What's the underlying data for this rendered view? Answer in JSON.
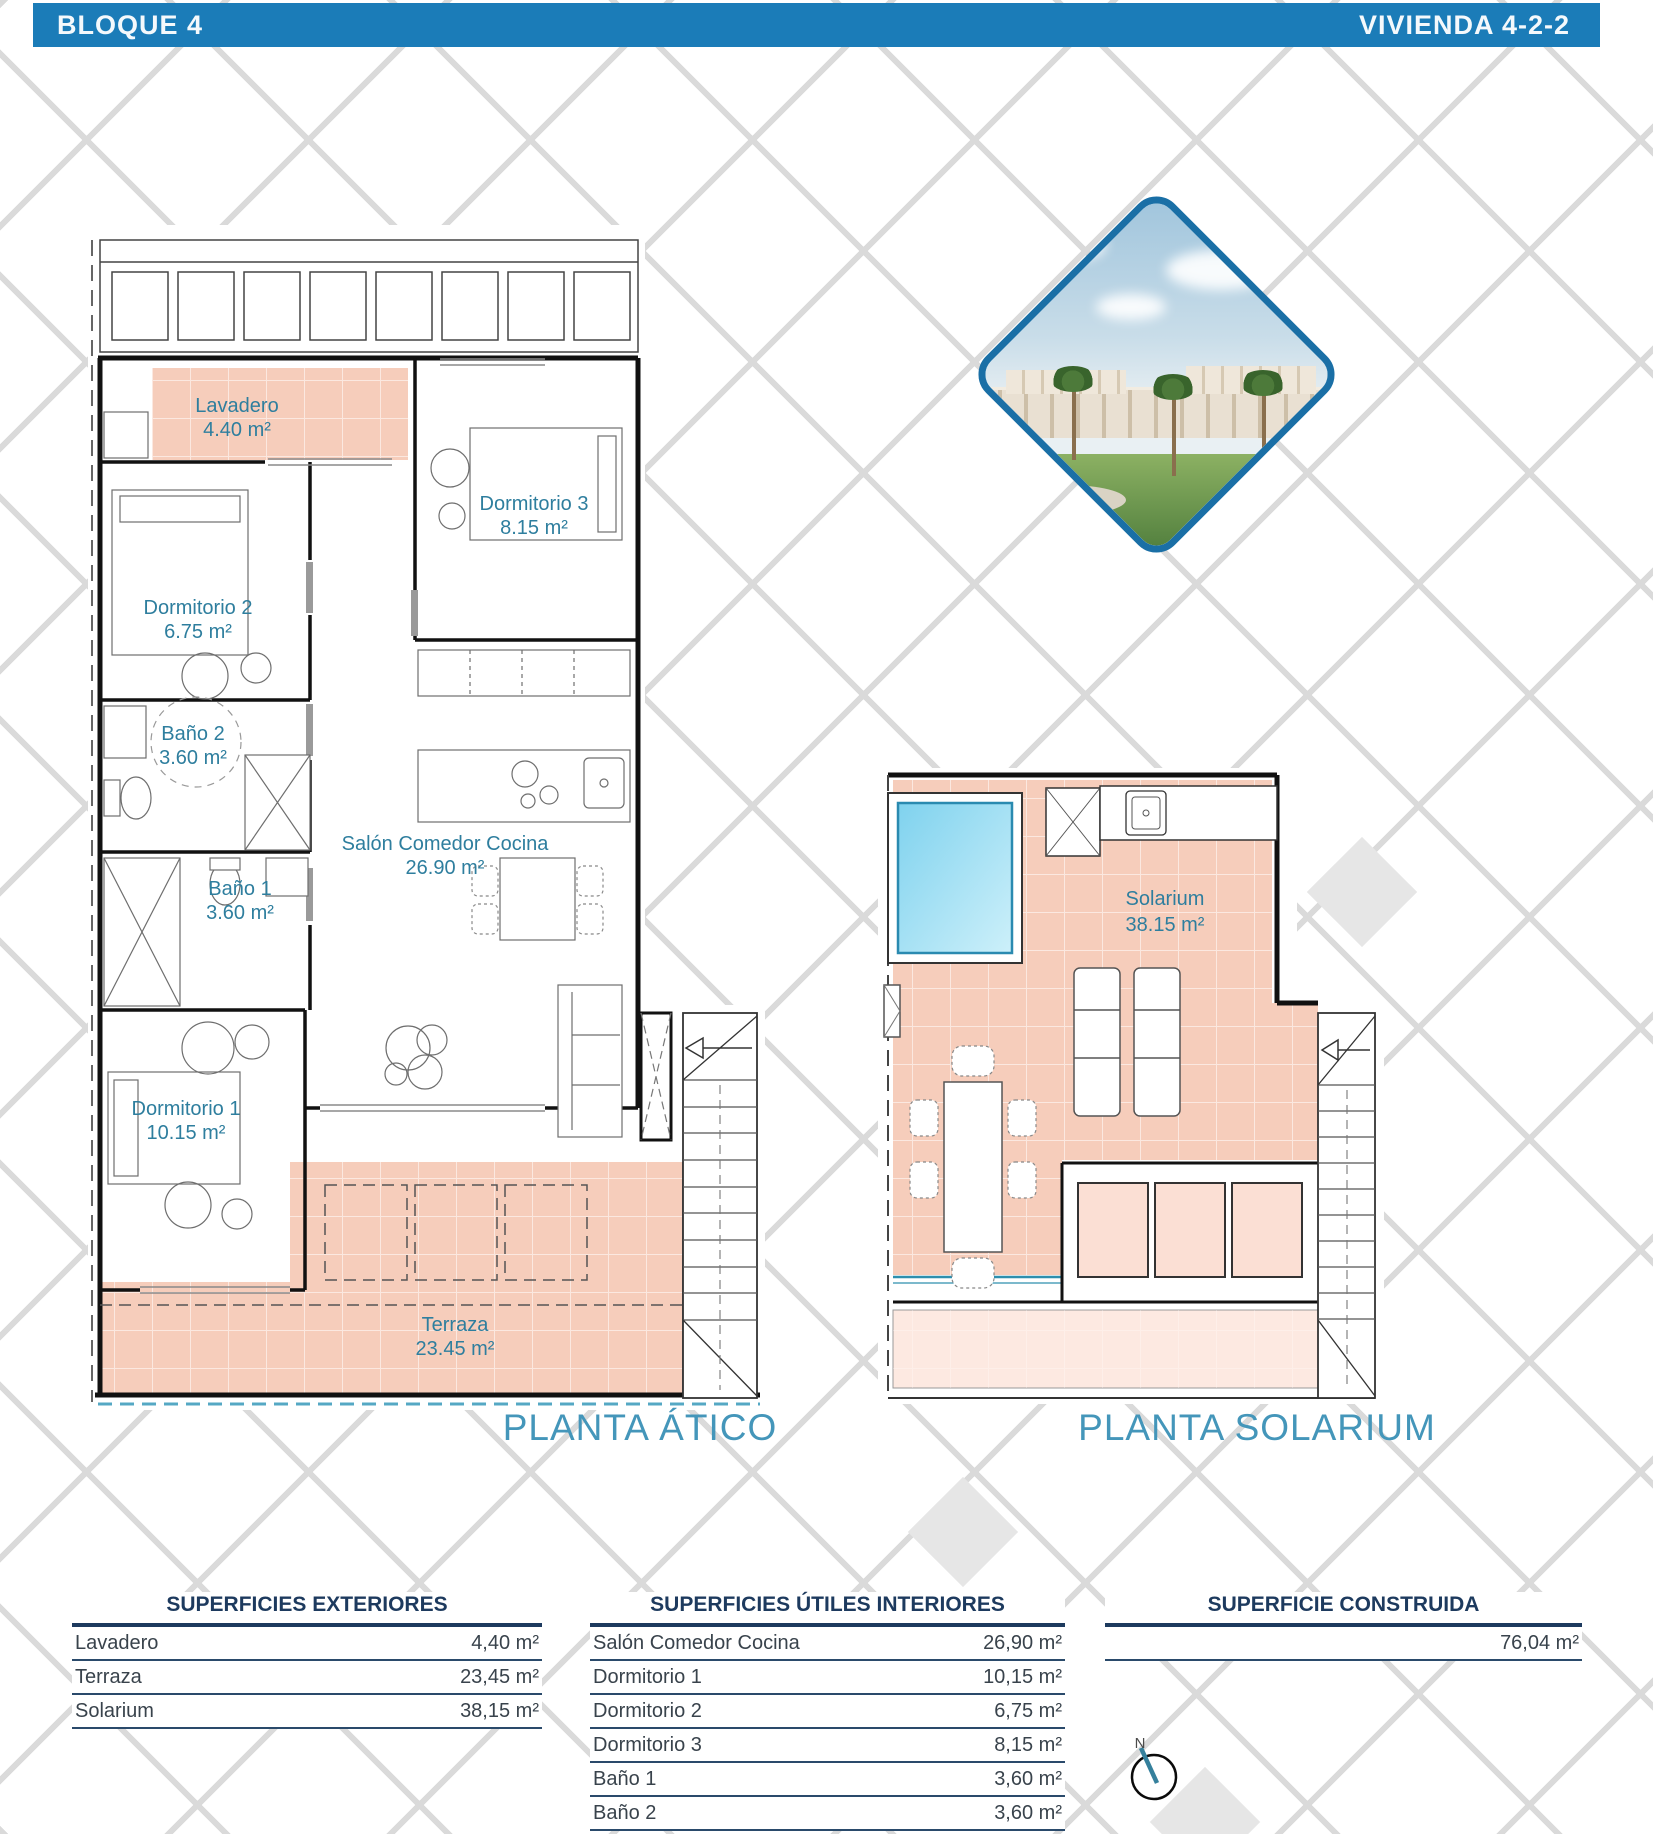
{
  "header": {
    "left_title": "BLOQUE 4",
    "right_title": "VIVIENDA 4-2-2"
  },
  "plans": {
    "atico": {
      "title": "PLANTA ÁTICO",
      "rooms": {
        "lavadero": {
          "name": "Lavadero",
          "area": "4.40 m²"
        },
        "dormitorio3": {
          "name": "Dormitorio 3",
          "area": "8.15 m²"
        },
        "dormitorio2": {
          "name": "Dormitorio 2",
          "area": "6.75 m²"
        },
        "bano2": {
          "name": "Baño 2",
          "area": "3.60 m²"
        },
        "bano1": {
          "name": "Baño 1",
          "area": "3.60 m²"
        },
        "salon": {
          "name": "Salón Comedor Cocina",
          "area": "26.90 m²"
        },
        "dormitorio1": {
          "name": "Dormitorio 1",
          "area": "10.15 m²"
        },
        "terraza": {
          "name": "Terraza",
          "area": "23.45 m²"
        }
      }
    },
    "solarium": {
      "title": "PLANTA SOLARIUM",
      "rooms": {
        "solarium": {
          "name": "Solarium",
          "area": "38.15 m²"
        }
      }
    }
  },
  "tables": {
    "exteriores": {
      "title": "SUPERFICIES EXTERIORES",
      "rows": [
        {
          "label": "Lavadero",
          "value": "4,40 m²"
        },
        {
          "label": "Terraza",
          "value": "23,45 m²"
        },
        {
          "label": "Solarium",
          "value": "38,15 m²"
        }
      ]
    },
    "interiores": {
      "title": "SUPERFICIES ÚTILES INTERIORES",
      "rows": [
        {
          "label": "Salón Comedor Cocina",
          "value": "26,90 m²"
        },
        {
          "label": "Dormitorio 1",
          "value": "10,15 m²"
        },
        {
          "label": "Dormitorio 2",
          "value": "6,75 m²"
        },
        {
          "label": "Dormitorio 3",
          "value": "8,15 m²"
        },
        {
          "label": "Baño 1",
          "value": "3,60 m²"
        },
        {
          "label": "Baño 2",
          "value": "3,60 m²"
        }
      ]
    },
    "construida": {
      "title": "SUPERFICIE CONSTRUIDA",
      "rows": [
        {
          "label": "",
          "value": "76,04 m²"
        }
      ]
    }
  },
  "compass": {
    "north_label": "N"
  },
  "colors": {
    "header_blue": "#1b7cb8",
    "room_label_teal": "#2e7e9e",
    "plan_title_blue": "#4496ba",
    "table_navy": "#1d3a5e",
    "tile_pink": "#f6cdbb",
    "skylight_pink": "#fbdfd4",
    "pool_blue": "#8fd9f2"
  }
}
